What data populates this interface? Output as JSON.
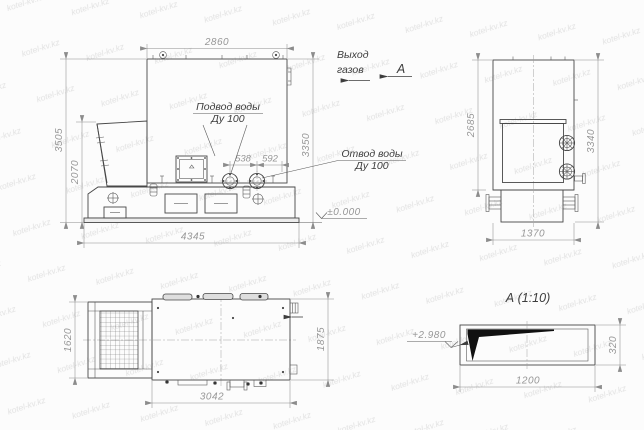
{
  "drawing": {
    "labels": {
      "gas_outlet": {
        "line1": "Выход",
        "line2": "газов"
      },
      "section_arrow": "А",
      "water_inlet": {
        "line1": "Подвод воды",
        "line2": "Ду 100"
      },
      "water_outlet": {
        "line1": "Отвод воды",
        "line2": "Ду 100"
      },
      "ground_level": "±0.000",
      "section_view_title": "А (1:10)",
      "section_elevation": "+2.980"
    },
    "dimensions": {
      "front_view": {
        "top_width": "2860",
        "overall_height": "3505",
        "hopper_height": "2070",
        "right_height": "3350",
        "base_width": "4345",
        "inlet_offset": "538",
        "outlet_offset": "592"
      },
      "side_view": {
        "body_height": "2685",
        "overall_height": "3340",
        "base_width": "1370"
      },
      "plan_view": {
        "grate_width": "1620",
        "overall_width": "1875",
        "body_length": "3042"
      },
      "section_a": {
        "duct_length": "1200",
        "duct_height": "320"
      }
    },
    "watermark_text": "kotel-kv.kz",
    "colors": {
      "outline": "#474747",
      "dim_lines": "#8c8c8c",
      "dim_text": "#979797",
      "label_text": "#3d3d3d",
      "background": "#fcfcfc",
      "wedge_fill": "#111111",
      "watermark": "#e2e2e2"
    }
  }
}
